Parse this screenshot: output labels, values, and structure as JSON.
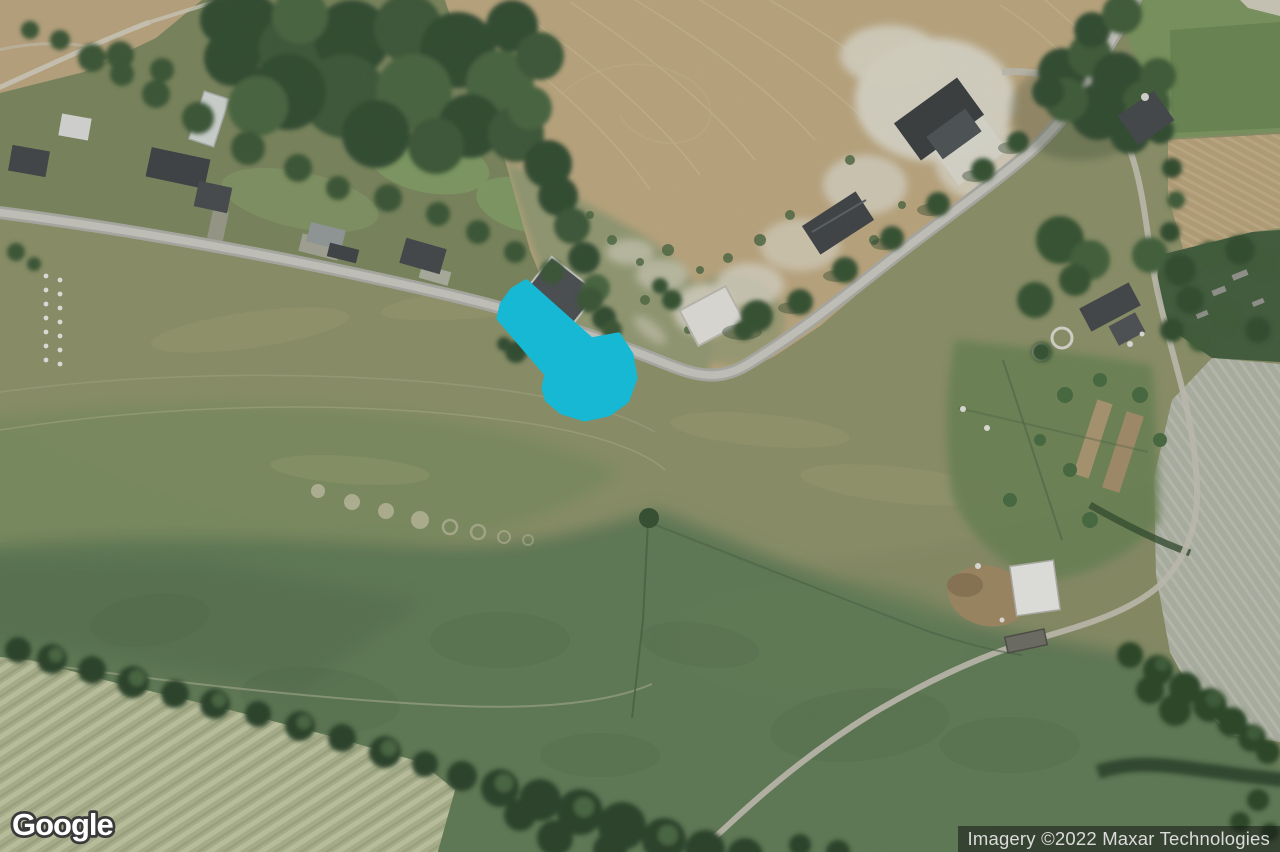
{
  "map": {
    "view": "satellite",
    "annotation": {
      "label": "highlight-arrow",
      "direction": "southeast",
      "color": "#16b8d4",
      "points": "526,283 591,341 618,336 630,355 634,378 626,400 608,413 585,418 562,411 548,399 545,388 548,374 500,318 503,305 513,291"
    },
    "watermark": {
      "text": "Google"
    },
    "attribution": {
      "text": "Imagery ©2022 Maxar Technologies"
    },
    "palette": {
      "field_olive": "#8c9265",
      "pasture_green": "#5e7d52",
      "cropland_tan": "#c9b183",
      "chalk_white": "#e9e4d2",
      "road_gray": "#b7b7af",
      "forest_green": "#2c4829",
      "pale_field": "#b6be94",
      "arrow_cyan": "#16b8d4",
      "attribution_bg": "rgba(22,25,22,0.55)",
      "attribution_text": "#dbdcda"
    }
  }
}
